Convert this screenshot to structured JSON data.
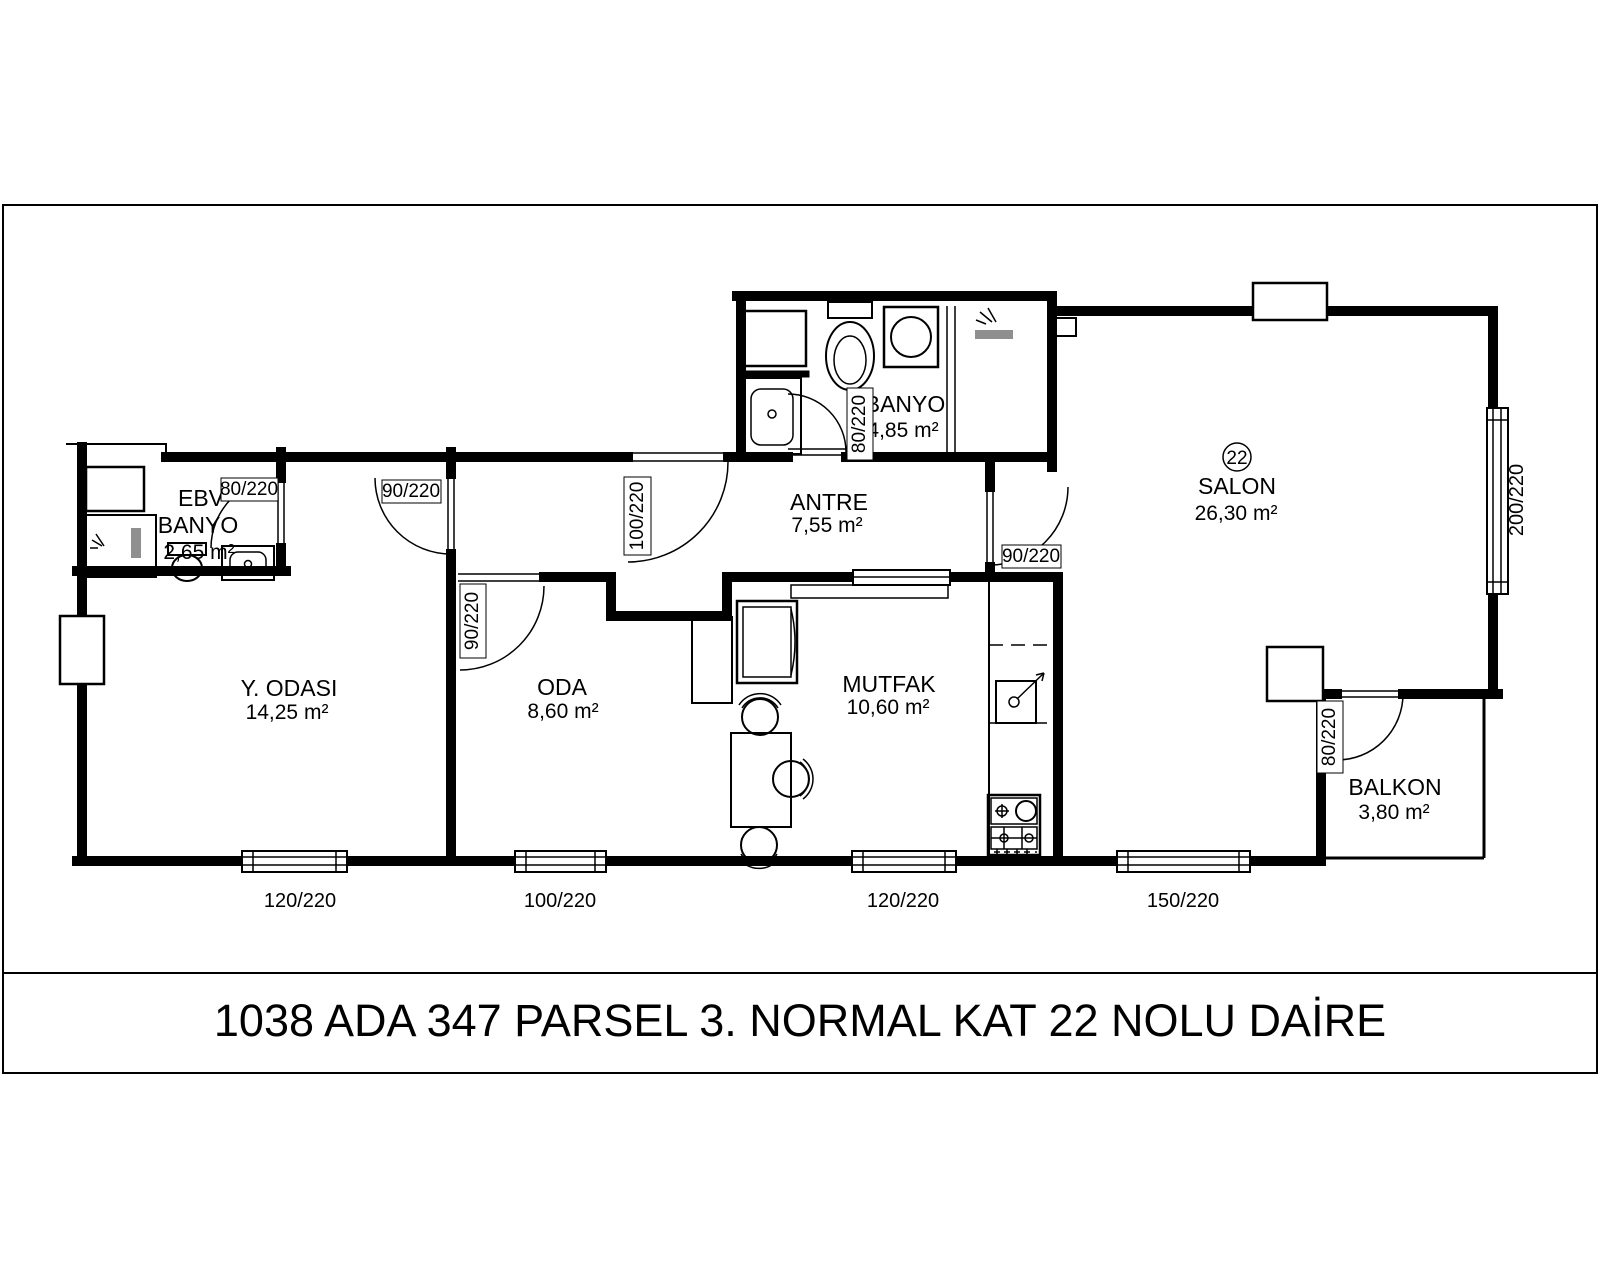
{
  "title": "1038 ADA 347 PARSEL 3. NORMAL KAT  22 NOLU DAİRE",
  "unit": {
    "number": "22"
  },
  "rooms": [
    {
      "id": "ebv-banyo",
      "name_line1": "EBV",
      "name_line2": "BANYO",
      "area": "2,65 m²"
    },
    {
      "id": "banyo",
      "name": "BANYO",
      "area": "4,85 m²"
    },
    {
      "id": "antre",
      "name": "ANTRE",
      "area": "7,55 m²"
    },
    {
      "id": "salon",
      "name": "SALON",
      "area": "26,30 m²"
    },
    {
      "id": "y-odasi",
      "name": "Y. ODASI",
      "area": "14,25 m²"
    },
    {
      "id": "oda",
      "name": "ODA",
      "area": "8,60 m²"
    },
    {
      "id": "mutfak",
      "name": "MUTFAK",
      "area": "10,60 m²"
    },
    {
      "id": "balkon",
      "name": "BALKON",
      "area": "3,80 m²"
    }
  ],
  "doors": [
    {
      "location": "ebv-banyo",
      "size": "80/220"
    },
    {
      "location": "y-odasi",
      "size": "90/220"
    },
    {
      "location": "entrance",
      "size": "100/220"
    },
    {
      "location": "oda",
      "size": "90/220"
    },
    {
      "location": "banyo",
      "size": "80/220"
    },
    {
      "location": "salon",
      "size": "90/220"
    },
    {
      "location": "balkon",
      "size": "80/220"
    }
  ],
  "windows": [
    {
      "location": "y-odasi-south",
      "size": "120/220"
    },
    {
      "location": "oda-south",
      "size": "100/220"
    },
    {
      "location": "mutfak-south",
      "size": "120/220"
    },
    {
      "location": "salon-south",
      "size": "150/220"
    },
    {
      "location": "salon-east",
      "size": "200/220"
    }
  ]
}
